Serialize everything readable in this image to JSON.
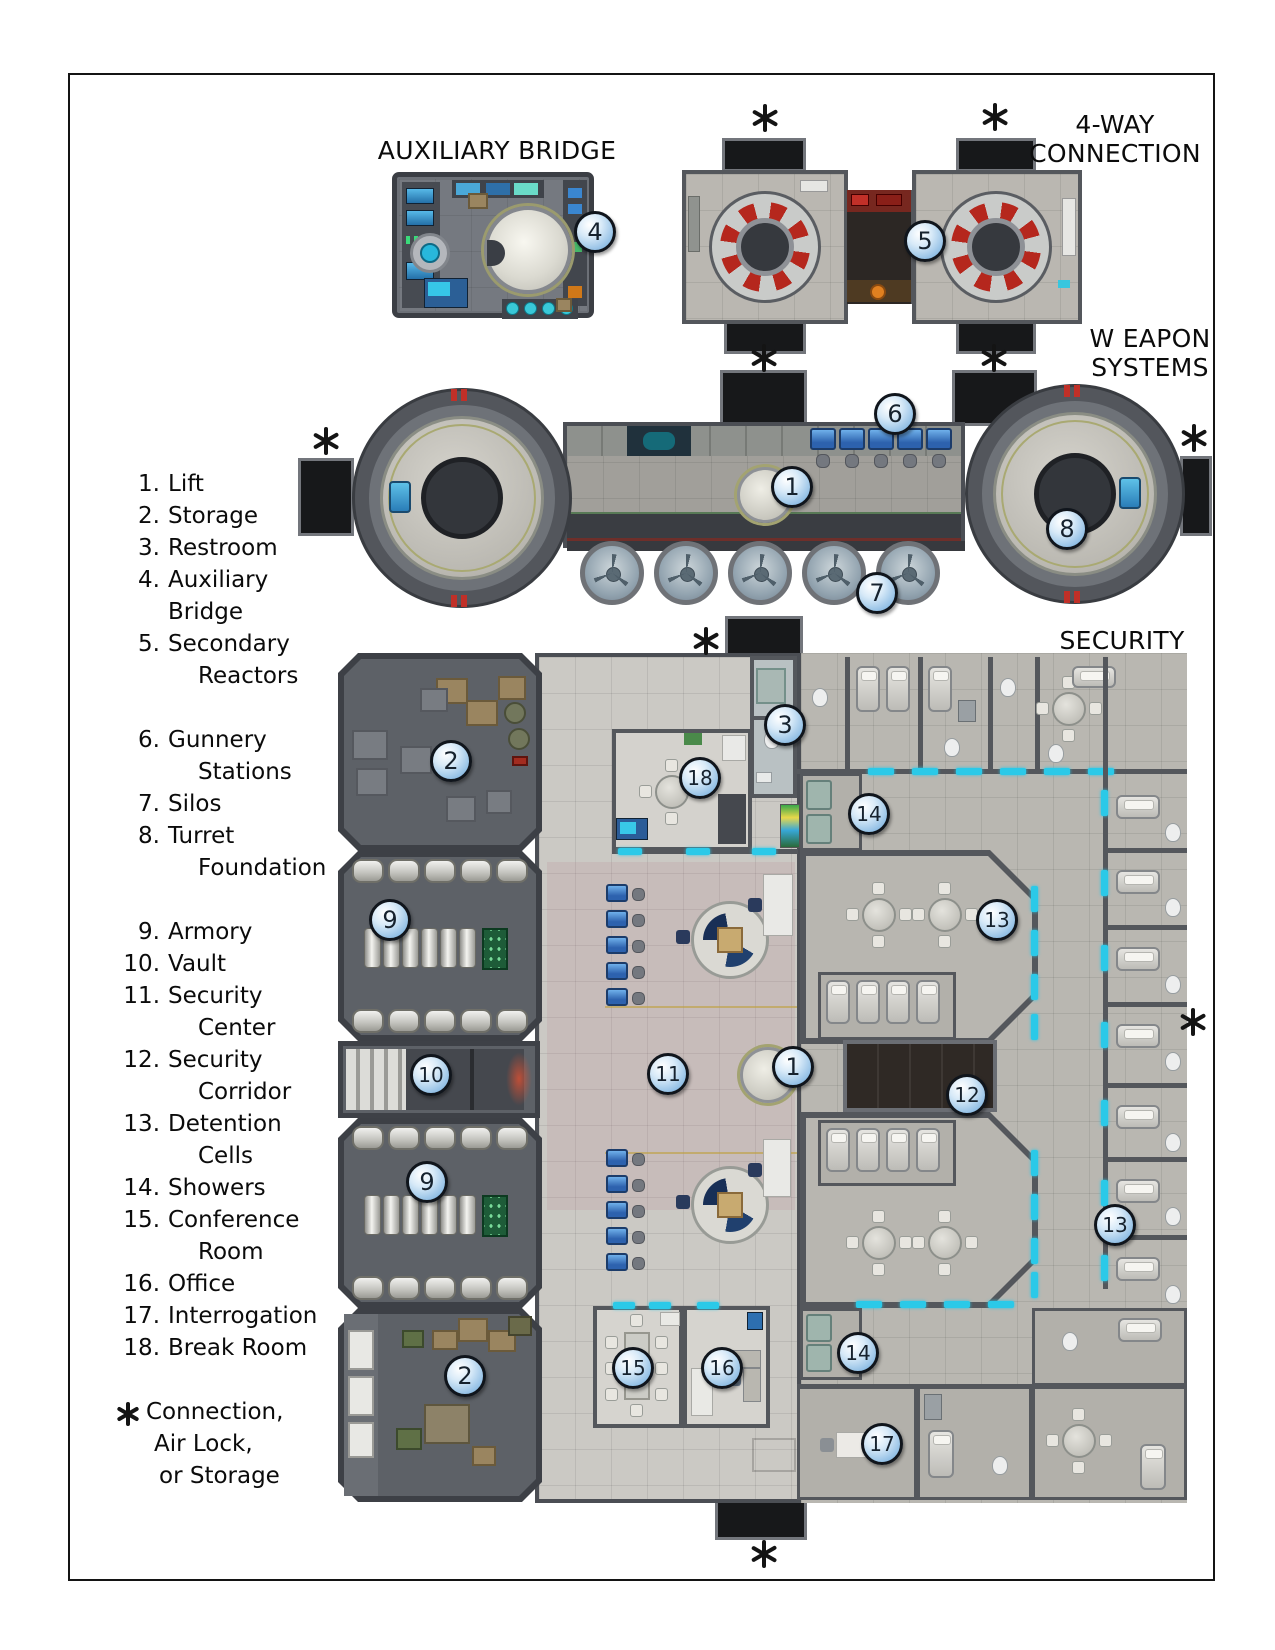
{
  "labels": {
    "aux_bridge": "AUXILIARY BRIDGE",
    "four_way_line1": "4-WAY",
    "four_way_line2": "CONNECTION",
    "weapon_line1": "W EAPON",
    "weapon_line2": "SYSTEMS",
    "security": "SECURITY"
  },
  "legend": {
    "groups": [
      [
        {
          "num": "1.",
          "lines": [
            "Lift"
          ]
        },
        {
          "num": "2.",
          "lines": [
            "Storage"
          ]
        },
        {
          "num": "3.",
          "lines": [
            "Restroom"
          ]
        },
        {
          "num": "4.",
          "lines": [
            "Auxiliary Bridge"
          ]
        },
        {
          "num": "5.",
          "lines": [
            "Secondary",
            "Reactors"
          ]
        }
      ],
      [
        {
          "num": "6.",
          "lines": [
            "Gunnery",
            "Stations"
          ]
        },
        {
          "num": "7.",
          "lines": [
            "Silos"
          ]
        },
        {
          "num": "8.",
          "lines": [
            "Turret",
            "Foundation"
          ]
        }
      ],
      [
        {
          "num": "9.",
          "lines": [
            "Armory"
          ]
        },
        {
          "num": "10.",
          "lines": [
            "Vault"
          ]
        },
        {
          "num": "11.",
          "lines": [
            "Security",
            "Center"
          ]
        },
        {
          "num": "12.",
          "lines": [
            "Security",
            "Corridor"
          ]
        },
        {
          "num": "13.",
          "lines": [
            "Detention",
            "Cells"
          ]
        },
        {
          "num": "14.",
          "lines": [
            "Showers"
          ]
        },
        {
          "num": "15.",
          "lines": [
            "Conference",
            "Room"
          ]
        },
        {
          "num": "16.",
          "lines": [
            "Office"
          ]
        },
        {
          "num": "17.",
          "lines": [
            "Interrogation"
          ]
        },
        {
          "num": "18.",
          "lines": [
            "Break Room"
          ]
        }
      ]
    ],
    "footnote": {
      "symbol": "*",
      "lines": [
        "Connection,",
        "Air Lock,",
        "or Storage"
      ]
    }
  },
  "map": {
    "marker_style": {
      "fill": "#bcdcf4",
      "border": "#10151c",
      "text_color": "#16222e"
    },
    "colors": {
      "wall": "#4b4e54",
      "floor_light": "#cbc9c4",
      "floor_dark": "#5d6167",
      "detention_floor": "#b9b7b1",
      "force_field_cyan": "#2bc9e8",
      "console_blue": "#2f6fc0",
      "reactor_red": "#b5271d",
      "stub_black": "#17181a",
      "lift_ring_olive": "#a3a371"
    },
    "markers": [
      {
        "n": "4",
        "room": "auxiliary-bridge",
        "x": 595,
        "y": 232
      },
      {
        "n": "5",
        "room": "secondary-reactors",
        "x": 925,
        "y": 241
      },
      {
        "n": "6",
        "room": "gunnery-stations",
        "x": 895,
        "y": 414
      },
      {
        "n": "1",
        "room": "lift",
        "x": 792,
        "y": 487
      },
      {
        "n": "8",
        "room": "turret-foundation",
        "x": 1067,
        "y": 529
      },
      {
        "n": "7",
        "room": "silos",
        "x": 877,
        "y": 593
      },
      {
        "n": "2",
        "room": "storage",
        "x": 451,
        "y": 761
      },
      {
        "n": "3",
        "room": "restroom",
        "x": 785,
        "y": 725
      },
      {
        "n": "18",
        "room": "break-room",
        "x": 700,
        "y": 778
      },
      {
        "n": "14",
        "room": "showers",
        "x": 869,
        "y": 814
      },
      {
        "n": "9",
        "room": "armory",
        "x": 390,
        "y": 920
      },
      {
        "n": "13",
        "room": "detention-cells",
        "x": 997,
        "y": 920
      },
      {
        "n": "10",
        "room": "vault",
        "x": 431,
        "y": 1075
      },
      {
        "n": "11",
        "room": "security-center",
        "x": 668,
        "y": 1074
      },
      {
        "n": "1",
        "room": "lift",
        "x": 793,
        "y": 1067
      },
      {
        "n": "12",
        "room": "security-corridor",
        "x": 967,
        "y": 1095
      },
      {
        "n": "9",
        "room": "armory",
        "x": 427,
        "y": 1182
      },
      {
        "n": "13",
        "room": "detention-cells",
        "x": 1115,
        "y": 1225
      },
      {
        "n": "2",
        "room": "storage",
        "x": 465,
        "y": 1376
      },
      {
        "n": "15",
        "room": "conference-room",
        "x": 633,
        "y": 1368
      },
      {
        "n": "16",
        "room": "office",
        "x": 722,
        "y": 1368
      },
      {
        "n": "14",
        "room": "showers",
        "x": 858,
        "y": 1353
      },
      {
        "n": "17",
        "room": "interrogation",
        "x": 882,
        "y": 1444
      }
    ],
    "asterisks": [
      {
        "x": 765,
        "y": 118
      },
      {
        "x": 995,
        "y": 117
      },
      {
        "x": 764,
        "y": 358
      },
      {
        "x": 994,
        "y": 358
      },
      {
        "x": 326,
        "y": 441
      },
      {
        "x": 1194,
        "y": 438
      },
      {
        "x": 706,
        "y": 641
      },
      {
        "x": 1193,
        "y": 1022
      },
      {
        "x": 764,
        "y": 1554
      }
    ]
  }
}
